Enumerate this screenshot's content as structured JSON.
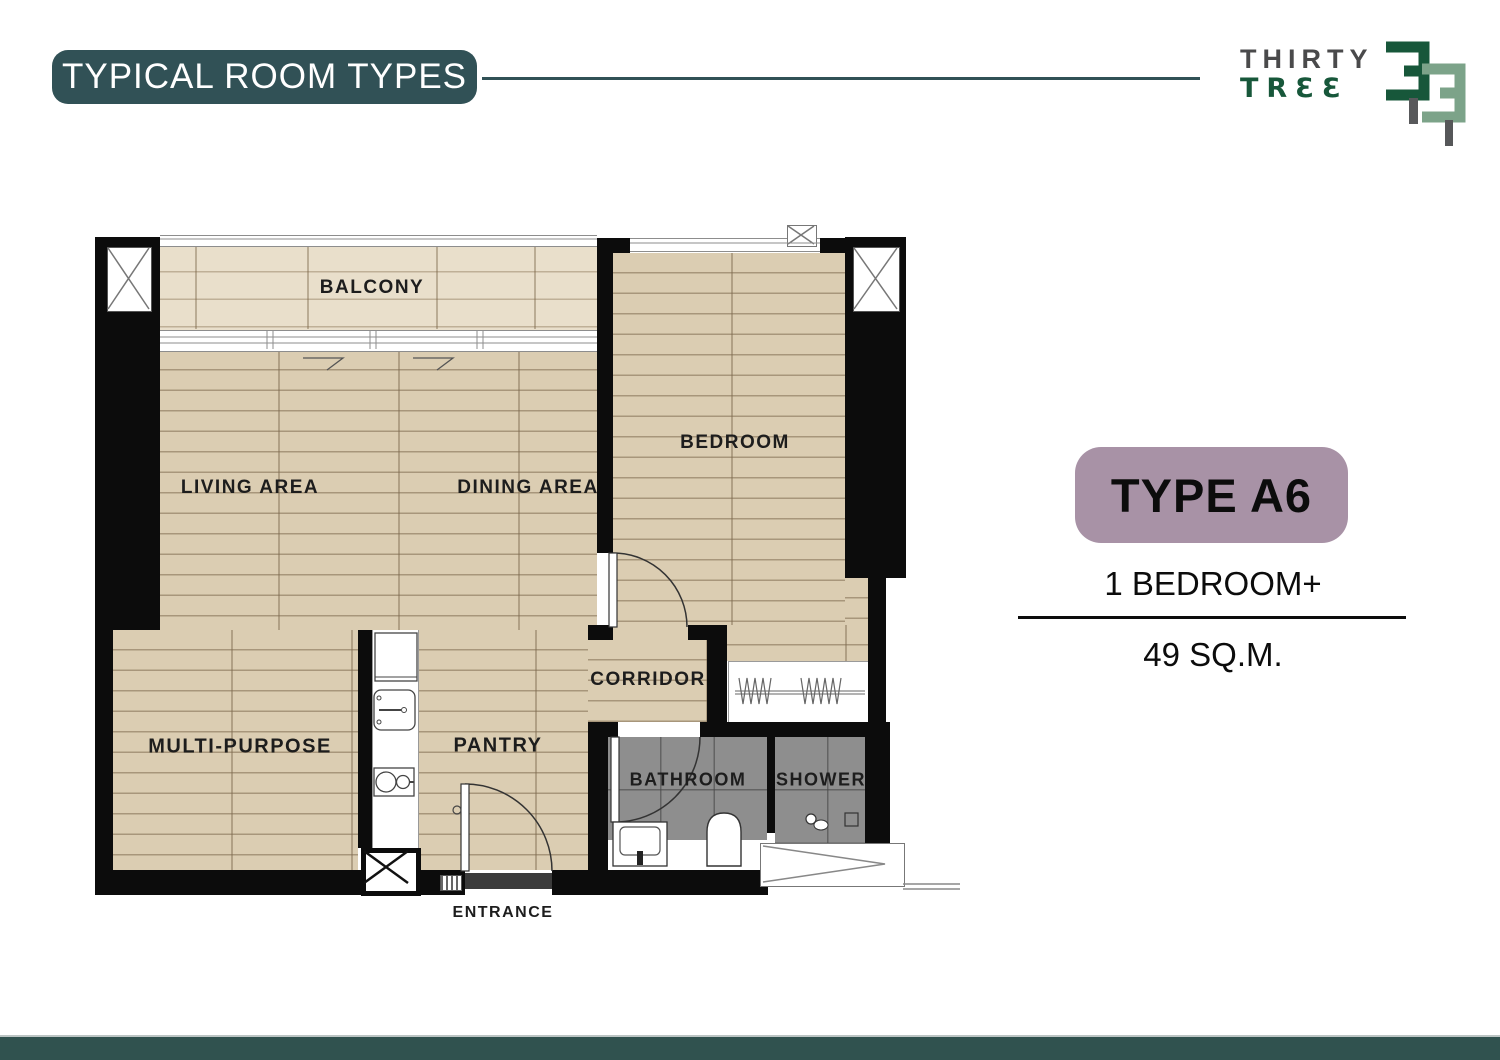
{
  "header": {
    "title": "TYPICAL ROOM TYPES"
  },
  "logo": {
    "line1": "THIRTY",
    "line2": "TRƐƐ"
  },
  "unit": {
    "type_label": "TYPE A6",
    "bedrooms": "1 BEDROOM+",
    "area": "49 SQ.M."
  },
  "plan": {
    "rooms": {
      "balcony": "BALCONY",
      "living": "LIVING AREA",
      "dining": "DINING AREA",
      "bedroom": "BEDROOM",
      "multi": "MULTI-PURPOSE",
      "corridor": "CORRIDOR",
      "pantry": "PANTRY",
      "bathroom": "BATHROOM",
      "shower": "SHOWER",
      "entrance": "ENTRANCE"
    }
  },
  "colors": {
    "teal": "#315156",
    "footer_teal": "#30524f",
    "mauve": "#a892a6",
    "wall_black": "#0c0c0c",
    "wood": "#dbcdb2",
    "balcony_wood": "#e9dfcb",
    "bath_tile": "#8e8e8e",
    "logo_green": "#17573a",
    "logo_sage": "#7ca389",
    "logo_gray": "#4a4a4b"
  }
}
